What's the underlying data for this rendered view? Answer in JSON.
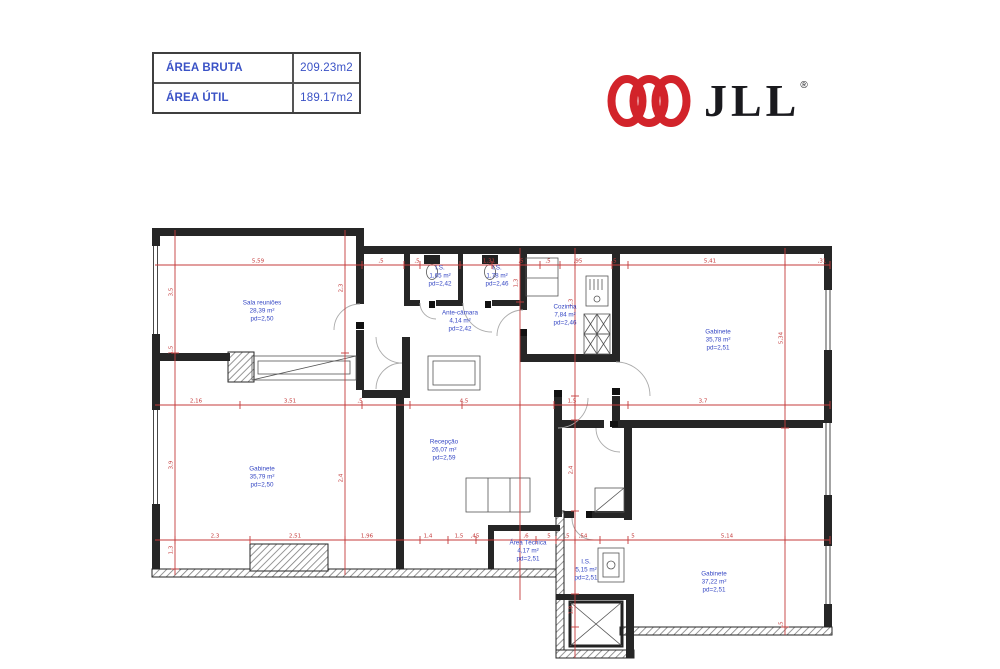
{
  "header_table": {
    "rows": [
      {
        "label": "ÁREA BRUTA",
        "value": "209.23m2"
      },
      {
        "label": "ÁREA ÚTIL",
        "value": "189.17m2"
      }
    ]
  },
  "logo": {
    "text": "JLL",
    "registered": "®",
    "brand_color": "#d2232a"
  },
  "colors": {
    "room_label": "#3547c4",
    "dimension": "#c43b3b",
    "wall": "#262626",
    "table_text": "#3a52c6"
  },
  "floorplan": {
    "dim_color": "#c43b3b",
    "rooms": [
      {
        "name": "Sala reuniões",
        "area": "28,39 m²",
        "pd": "pd=2,50",
        "x": 262,
        "y": 312
      },
      {
        "name": "Gabinete",
        "area": "35,79 m²",
        "pd": "pd=2,50",
        "x": 262,
        "y": 478
      },
      {
        "name": "I.S.",
        "area": "1,65 m²",
        "pd": "pd=2,42",
        "x": 440,
        "y": 277
      },
      {
        "name": "I.S.",
        "area": "1,78 m²",
        "pd": "pd=2,46",
        "x": 497,
        "y": 277
      },
      {
        "name": "Ante-câmara",
        "area": "4,14 m²",
        "pd": "pd=2,42",
        "x": 460,
        "y": 322
      },
      {
        "name": "Cozinha",
        "area": "7,84 m²",
        "pd": "pd=2,46",
        "x": 565,
        "y": 316
      },
      {
        "name": "Gabinete",
        "area": "35,78 m²",
        "pd": "pd=2,51",
        "x": 718,
        "y": 341
      },
      {
        "name": "Recepção",
        "area": "26,07 m²",
        "pd": "pd=2,59",
        "x": 444,
        "y": 451
      },
      {
        "name": "Área Técnica",
        "area": "4,17 m²",
        "pd": "pd=2,51",
        "x": 528,
        "y": 552
      },
      {
        "name": "I.S.",
        "area": "5,15 m²",
        "pd": "pd=2,51",
        "x": 586,
        "y": 571
      },
      {
        "name": "Gabinete",
        "area": "37,22 m²",
        "pd": "pd=2,51",
        "x": 714,
        "y": 583
      }
    ],
    "dims": {
      "h_lines": [
        {
          "y": 265,
          "x1": 155,
          "x2": 830,
          "ticks": [
            175,
            345,
            362,
            404,
            420,
            460,
            492,
            520,
            540,
            560,
            575,
            612,
            628,
            785,
            830
          ],
          "labels": [
            {
              "x": 258,
              "t": "5,59"
            },
            {
              "x": 381,
              "t": ",5"
            },
            {
              "x": 417,
              "t": ",5"
            },
            {
              "x": 489,
              "t": "1,31"
            },
            {
              "x": 521,
              "t": ",5"
            },
            {
              "x": 548,
              "t": ",5"
            },
            {
              "x": 578,
              "t": ",95"
            },
            {
              "x": 614,
              "t": ",5"
            },
            {
              "x": 710,
              "t": "5,41"
            },
            {
              "x": 822,
              "t": ",31"
            }
          ]
        },
        {
          "y": 405,
          "x1": 155,
          "x2": 830,
          "ticks": [
            175,
            240,
            345,
            362,
            410,
            462,
            520,
            554,
            575,
            628,
            785,
            830
          ],
          "labels": [
            {
              "x": 196,
              "t": "2,16"
            },
            {
              "x": 290,
              "t": "3,51"
            },
            {
              "x": 360,
              "t": ",5"
            },
            {
              "x": 464,
              "t": "4,5"
            },
            {
              "x": 572,
              "t": "1,5"
            },
            {
              "x": 703,
              "t": "3,7"
            }
          ]
        },
        {
          "y": 540,
          "x1": 155,
          "x2": 830,
          "ticks": [
            175,
            250,
            345,
            420,
            448,
            476,
            520,
            536,
            556,
            575,
            600,
            628,
            785,
            830
          ],
          "labels": [
            {
              "x": 215,
              "t": "2,3"
            },
            {
              "x": 295,
              "t": "2,51"
            },
            {
              "x": 367,
              "t": "1,96"
            },
            {
              "x": 428,
              "t": "1,4"
            },
            {
              "x": 459,
              "t": "1,5"
            },
            {
              "x": 475,
              "t": ",45"
            },
            {
              "x": 526,
              "t": ",6"
            },
            {
              "x": 549,
              "t": "5"
            },
            {
              "x": 567,
              "t": ",5"
            },
            {
              "x": 583,
              "t": ",54"
            },
            {
              "x": 633,
              "t": "5"
            },
            {
              "x": 727,
              "t": "5,14"
            }
          ]
        }
      ],
      "v_lines": [
        {
          "x": 175,
          "y1": 230,
          "y2": 575,
          "ticks": [
            265,
            353,
            405,
            540,
            569
          ],
          "labels": [
            {
              "y": 292,
              "t": "3,5"
            },
            {
              "y": 350,
              "t": "1,5"
            },
            {
              "y": 465,
              "t": "3,9"
            },
            {
              "y": 550,
              "t": "1,3"
            }
          ]
        },
        {
          "x": 345,
          "y1": 230,
          "y2": 575,
          "ticks": [
            265,
            353,
            405,
            540
          ],
          "labels": [
            {
              "y": 288,
              "t": "2,3"
            },
            {
              "y": 478,
              "t": "2,4"
            }
          ]
        },
        {
          "x": 520,
          "y1": 248,
          "y2": 600,
          "ticks": [
            265,
            302,
            405,
            540
          ],
          "labels": [
            {
              "y": 283,
              "t": "1,3"
            }
          ]
        },
        {
          "x": 575,
          "y1": 248,
          "y2": 658,
          "ticks": [
            265,
            396,
            420,
            511,
            540,
            594,
            627
          ],
          "labels": [
            {
              "y": 303,
              "t": "1,3"
            },
            {
              "y": 470,
              "t": "2,4"
            },
            {
              "y": 610,
              "t": "1,9"
            }
          ]
        },
        {
          "x": 785,
          "y1": 248,
          "y2": 635,
          "ticks": [
            265,
            405,
            428,
            540,
            627
          ],
          "labels": [
            {
              "y": 338,
              "t": "5,34"
            },
            {
              "y": 624,
              "t": ",5"
            }
          ]
        }
      ]
    }
  }
}
